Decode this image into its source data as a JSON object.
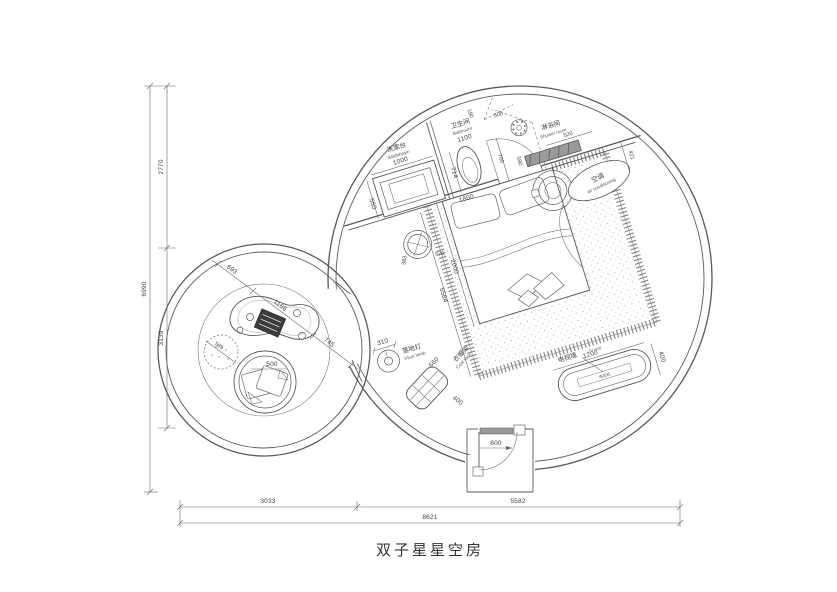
{
  "title": "双子星星空房",
  "labels": {
    "washbasin_zh": "洗漱台",
    "washbasin_en": "Washbasin",
    "bathroom_zh": "卫生间",
    "bathroom_en": "Bathroom",
    "shower_zh": "淋浴间",
    "shower_en": "Shower room",
    "ac_zh": "空调",
    "ac_en": "air conditioning",
    "lamp_zh": "落地灯",
    "lamp_en": "Floor lamp",
    "coat_zh": "衣帽架",
    "coat_en": "Coat rack",
    "tv_zh": "电视墙",
    "tv_en": "TV wall",
    "tv_unit": "电视机"
  },
  "dims": {
    "left_top": "2770",
    "left_bottom": "3139",
    "left_total": "6990",
    "bottom_left": "3033",
    "bottom_right": "5582",
    "bottom_total": "8621",
    "washbasin_width": "1000",
    "washbasin_depth": "550",
    "wall_seg_190": "190",
    "bath_door": "700",
    "bathroom_width": "1100",
    "toilet_depth": "714",
    "shower_door": "500",
    "wall_seg_590": "590",
    "bench": "520",
    "ac_offset": "421",
    "bed_width": "1800",
    "bed_length": "2000",
    "platform_length": "5584",
    "side_table_a": "383",
    "side_table_b": "570",
    "lamp_dia": "310",
    "coat_width": "660",
    "coat_depth": "400",
    "tv_width": "1200",
    "tv_depth": "400",
    "entry_door": "800",
    "lounge_a": "693",
    "lounge_b": "1166",
    "lounge_c": "745",
    "pouf_dia": "589",
    "chair_cushion": "500"
  }
}
